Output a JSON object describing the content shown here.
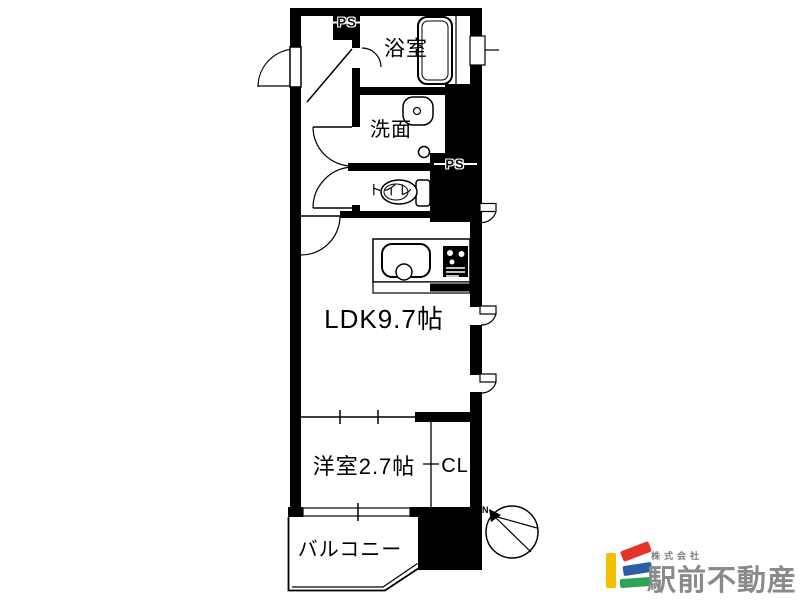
{
  "plan": {
    "rooms": [
      {
        "id": "bathroom",
        "label": "浴室"
      },
      {
        "id": "washroom",
        "label": "洗面"
      },
      {
        "id": "toilet",
        "label": "トイレ"
      },
      {
        "id": "ldk",
        "label": "LDK9.7帖"
      },
      {
        "id": "western_room",
        "label": "洋室2.7帖"
      },
      {
        "id": "closet",
        "label": "CL"
      },
      {
        "id": "balcony",
        "label": "バルコニー"
      }
    ],
    "pipe_space_label": "PS",
    "compass_label": "N"
  },
  "logo": {
    "company_prefix": "株式会社",
    "company_name": "駅前不動産",
    "colors": {
      "yellow": "#f3c000",
      "red": "#e0342c",
      "blue": "#2b5fa7",
      "green": "#2fa457",
      "text": "#8a8a8a"
    }
  },
  "colors": {
    "plan_line": "#000000",
    "background": "#ffffff"
  }
}
